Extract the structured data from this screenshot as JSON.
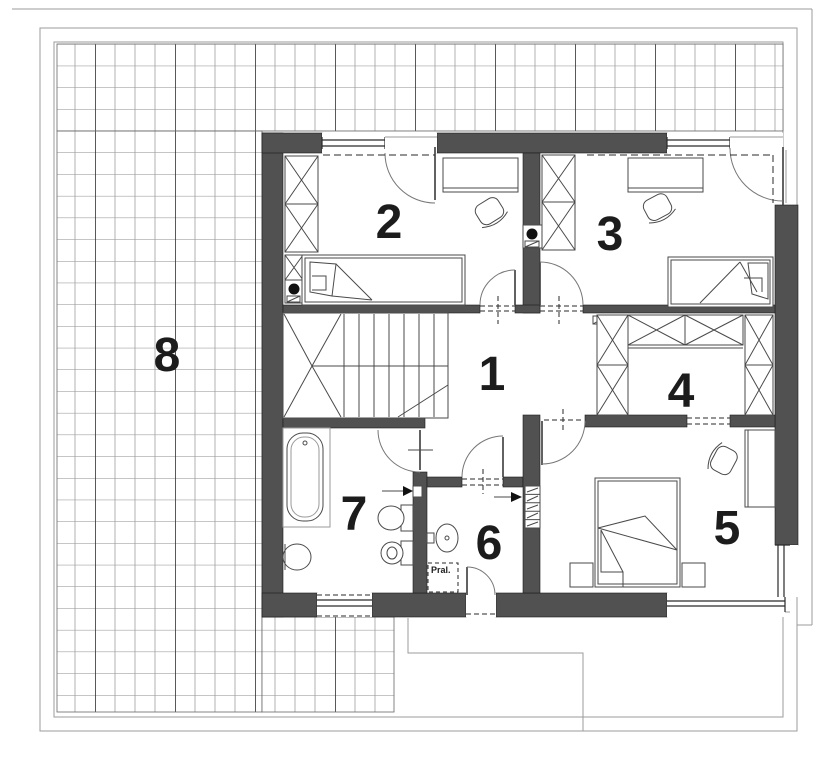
{
  "rooms": [
    {
      "number": "1"
    },
    {
      "number": "2"
    },
    {
      "number": "3"
    },
    {
      "number": "4"
    },
    {
      "number": "5"
    },
    {
      "number": "6"
    },
    {
      "number": "7"
    },
    {
      "number": "8"
    }
  ],
  "labels": {
    "washing_machine": "Pral."
  },
  "colors": {
    "wall": "#515151",
    "line": "#1c1c1c",
    "furniture": "#4a4a4a",
    "frame": "#9b9b9b",
    "dash": "#2a2a2a",
    "grid_row": "#8a8a8a",
    "grid_light": "#a0a0a0",
    "grid_heavy": "#2f2f2f"
  }
}
